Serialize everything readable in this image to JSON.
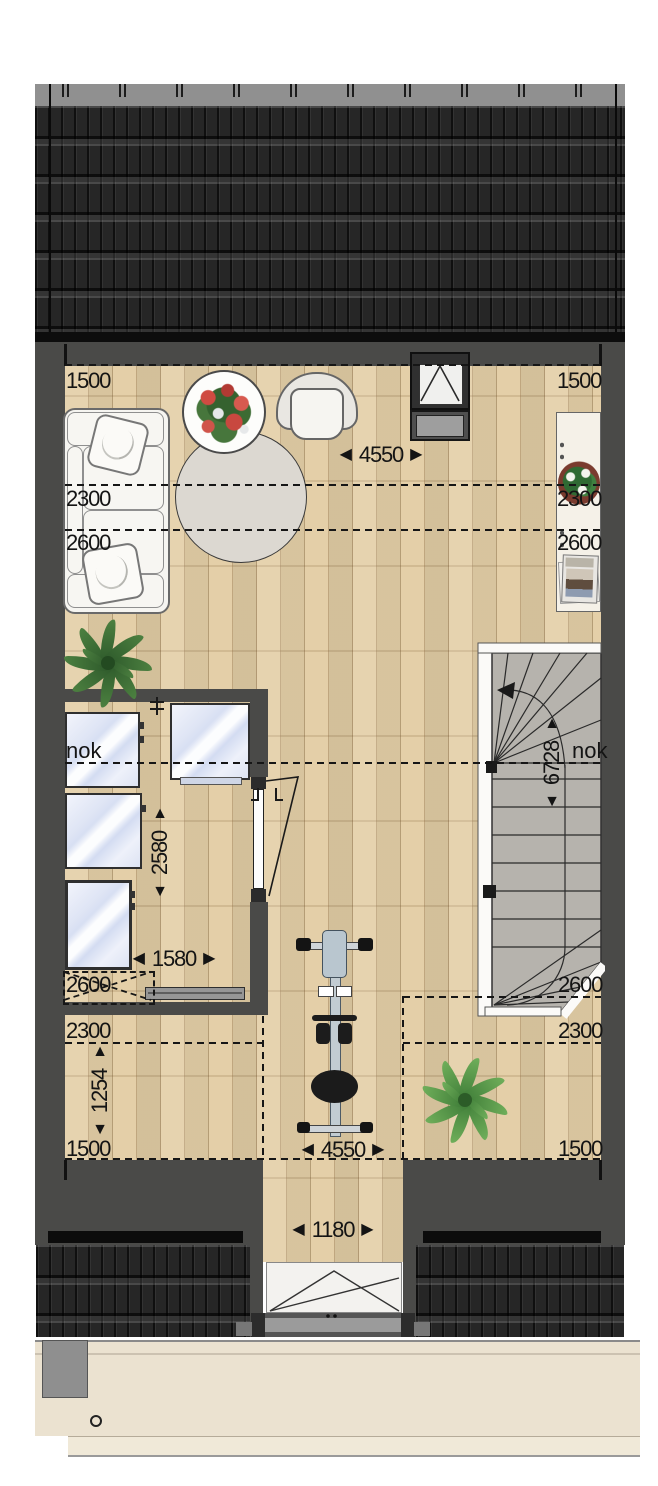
{
  "icons": {
    "arrow_left": "◀",
    "arrow_right": "▶",
    "arrow_up": "▲",
    "arrow_down": "▼"
  },
  "plan": {
    "ridge": {
      "left": "nok",
      "right": "nok"
    },
    "dims": {
      "top_width": "4550",
      "bottom_width": "4550",
      "dormer_width": "1180",
      "closet_width": "1580",
      "closet_depth": "2580",
      "stair_depth": "6728",
      "niche_depth": "1254",
      "top_left_1500": "1500",
      "top_right_1500": "1500",
      "left_2300": "2300",
      "left_2600": "2600",
      "right_2300": "2300",
      "right_2600": "2600",
      "bottom_left_2600": "2600",
      "bottom_left_2300": "2300",
      "bottom_left_1500": "1500",
      "bottom_right_2600": "2600",
      "bottom_right_2300": "2300",
      "bottom_right_1500": "1500"
    }
  }
}
